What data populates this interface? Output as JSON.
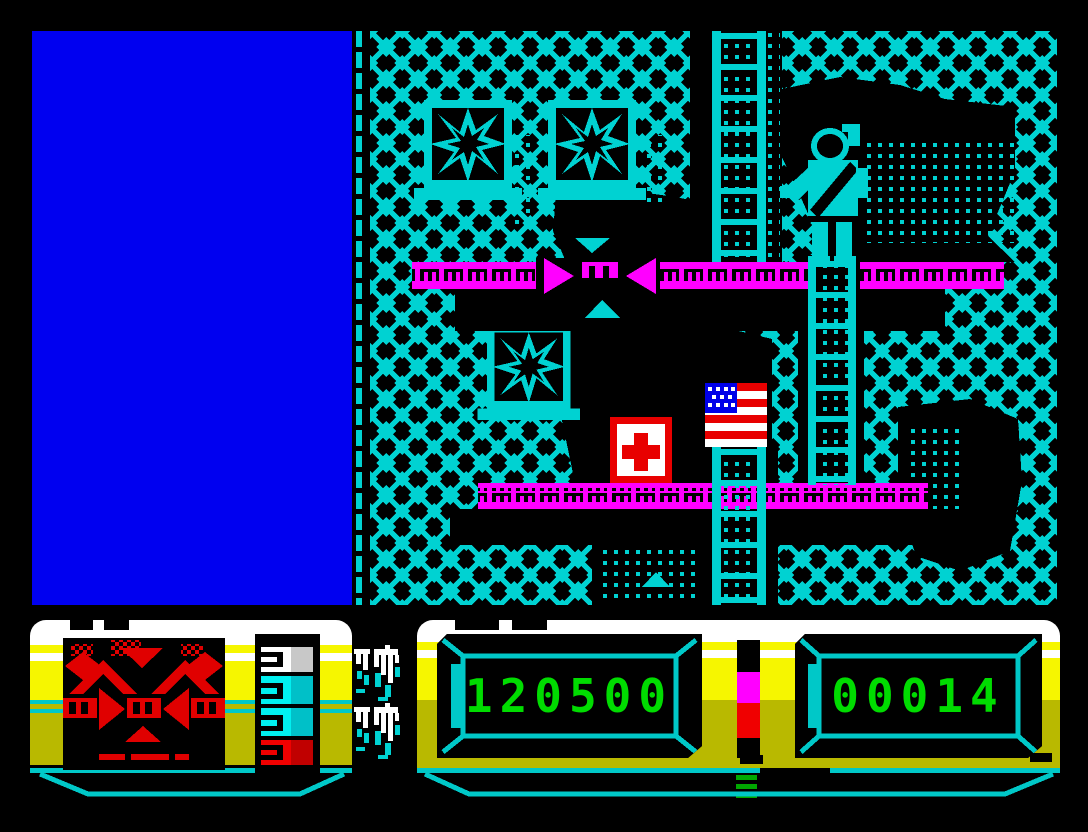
{
  "hud": {
    "score_display_value": "120500",
    "right_display_value": "00014",
    "left_meter_segments": [
      "white",
      "cyan",
      "cyan",
      "red"
    ],
    "center_meter_segments": [
      "black",
      "magenta",
      "red"
    ]
  },
  "colors": {
    "border_black": "#000000",
    "panel_blue": "#0000f0",
    "game_cyan": "#00d2d2",
    "platform_magenta": "#ff00ff",
    "hud_yellow": "#f6f600",
    "hud_olive": "#b9b900",
    "hud_cyan": "#00c8c8",
    "digit_green": "#00dc00",
    "radar_red": "#e00000",
    "flag_canton_blue": "#0000e8",
    "white": "#ffffff"
  },
  "icons": {
    "game_entities": [
      "chain-link-backdrop-icon",
      "cracked-window-icon",
      "girder-platform-icon",
      "direction-arrow-icon",
      "ladder-icon",
      "american-flag-icon",
      "first-aid-kit-icon",
      "soldier-climbing-icon",
      "smoke-silhouette-icon"
    ],
    "hud_glyphs": [
      "debris-glyph-icon",
      "debris-glyph-icon"
    ]
  }
}
